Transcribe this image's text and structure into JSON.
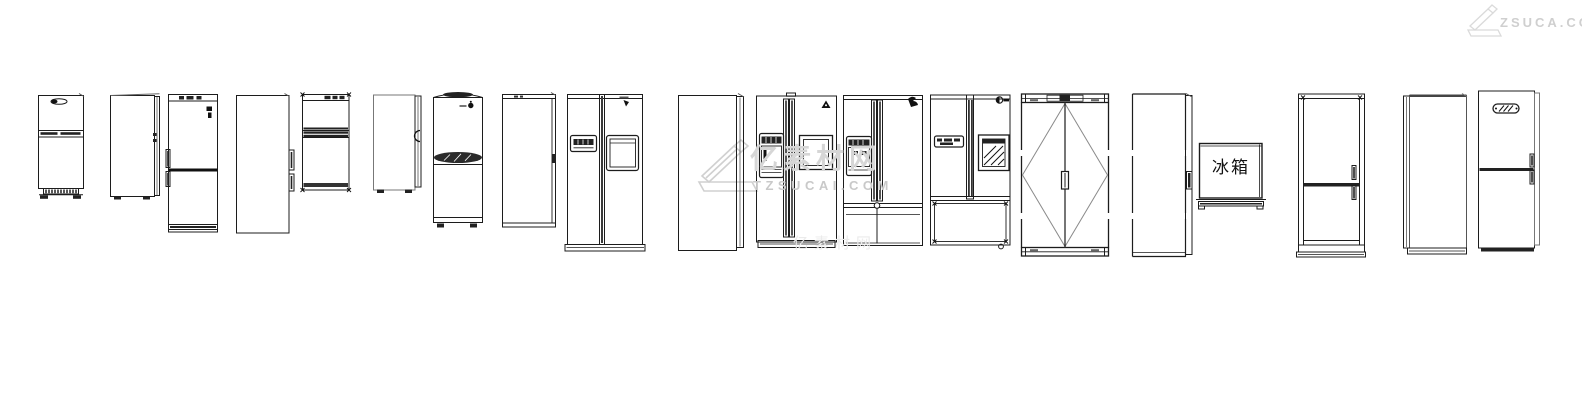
{
  "page": {
    "background": "#ffffff",
    "line_color": "#1c1c1c",
    "secondary_line_color": "#777777",
    "watermark_color": "#d6d6d6"
  },
  "label_block": {
    "text": "冰箱"
  },
  "watermarks": {
    "center_logo_icon": "tz-sucai-roller-logo",
    "center_cn": "亿素材网",
    "center_en": "TZSUCAI.COM",
    "corner_logo_icon": "tz-sucai-roller-logo",
    "corner": "ZSUCA.CO",
    "faint": "亿素材网"
  },
  "blocks": [
    {
      "name": "top-freezer-fridge-with-vent-grille"
    },
    {
      "name": "fridge-side-view-panel"
    },
    {
      "name": "bottom-freezer-fridge-left-handles"
    },
    {
      "name": "fridge-side-panel-two-handles"
    },
    {
      "name": "compact-top-freezer-fridge"
    },
    {
      "name": "fridge-side-view-gray"
    },
    {
      "name": "arch-top-fridge-with-lens-band"
    },
    {
      "name": "single-door-fridge"
    },
    {
      "name": "side-by-side-fridge-dispenser"
    },
    {
      "name": "fridge-side-panel-door-edge"
    },
    {
      "name": "side-by-side-fridge-long-handles"
    },
    {
      "name": "french-door-fridge-two-drawers"
    },
    {
      "name": "side-by-side-fridge-hatch-window"
    },
    {
      "name": "double-door-fridge-diamond-symbol"
    },
    {
      "name": "fridge-panel-dashed-outline"
    },
    {
      "name": "labeled-fridge-box"
    },
    {
      "name": "framed-bottom-freezer-fridge"
    },
    {
      "name": "fridge-side-view-left-door-edge"
    },
    {
      "name": "bottom-freezer-fridge-oval-badge"
    }
  ]
}
